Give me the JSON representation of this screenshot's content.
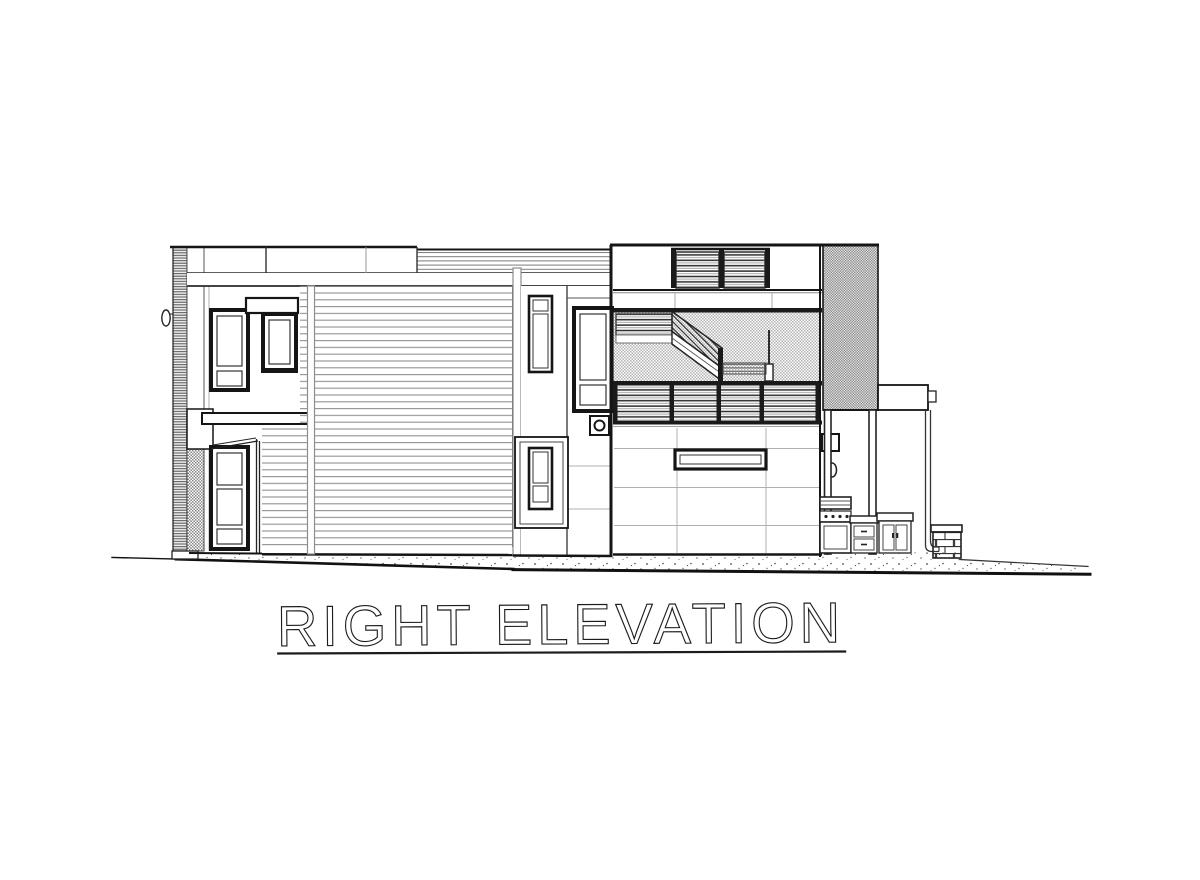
{
  "sheet": {
    "title": "RIGHT ELEVATION",
    "background": "#ffffff",
    "ink": "#1a1a1a",
    "muted_line": "#a8a8a8",
    "hatch_gray": "#8a8a8a"
  }
}
